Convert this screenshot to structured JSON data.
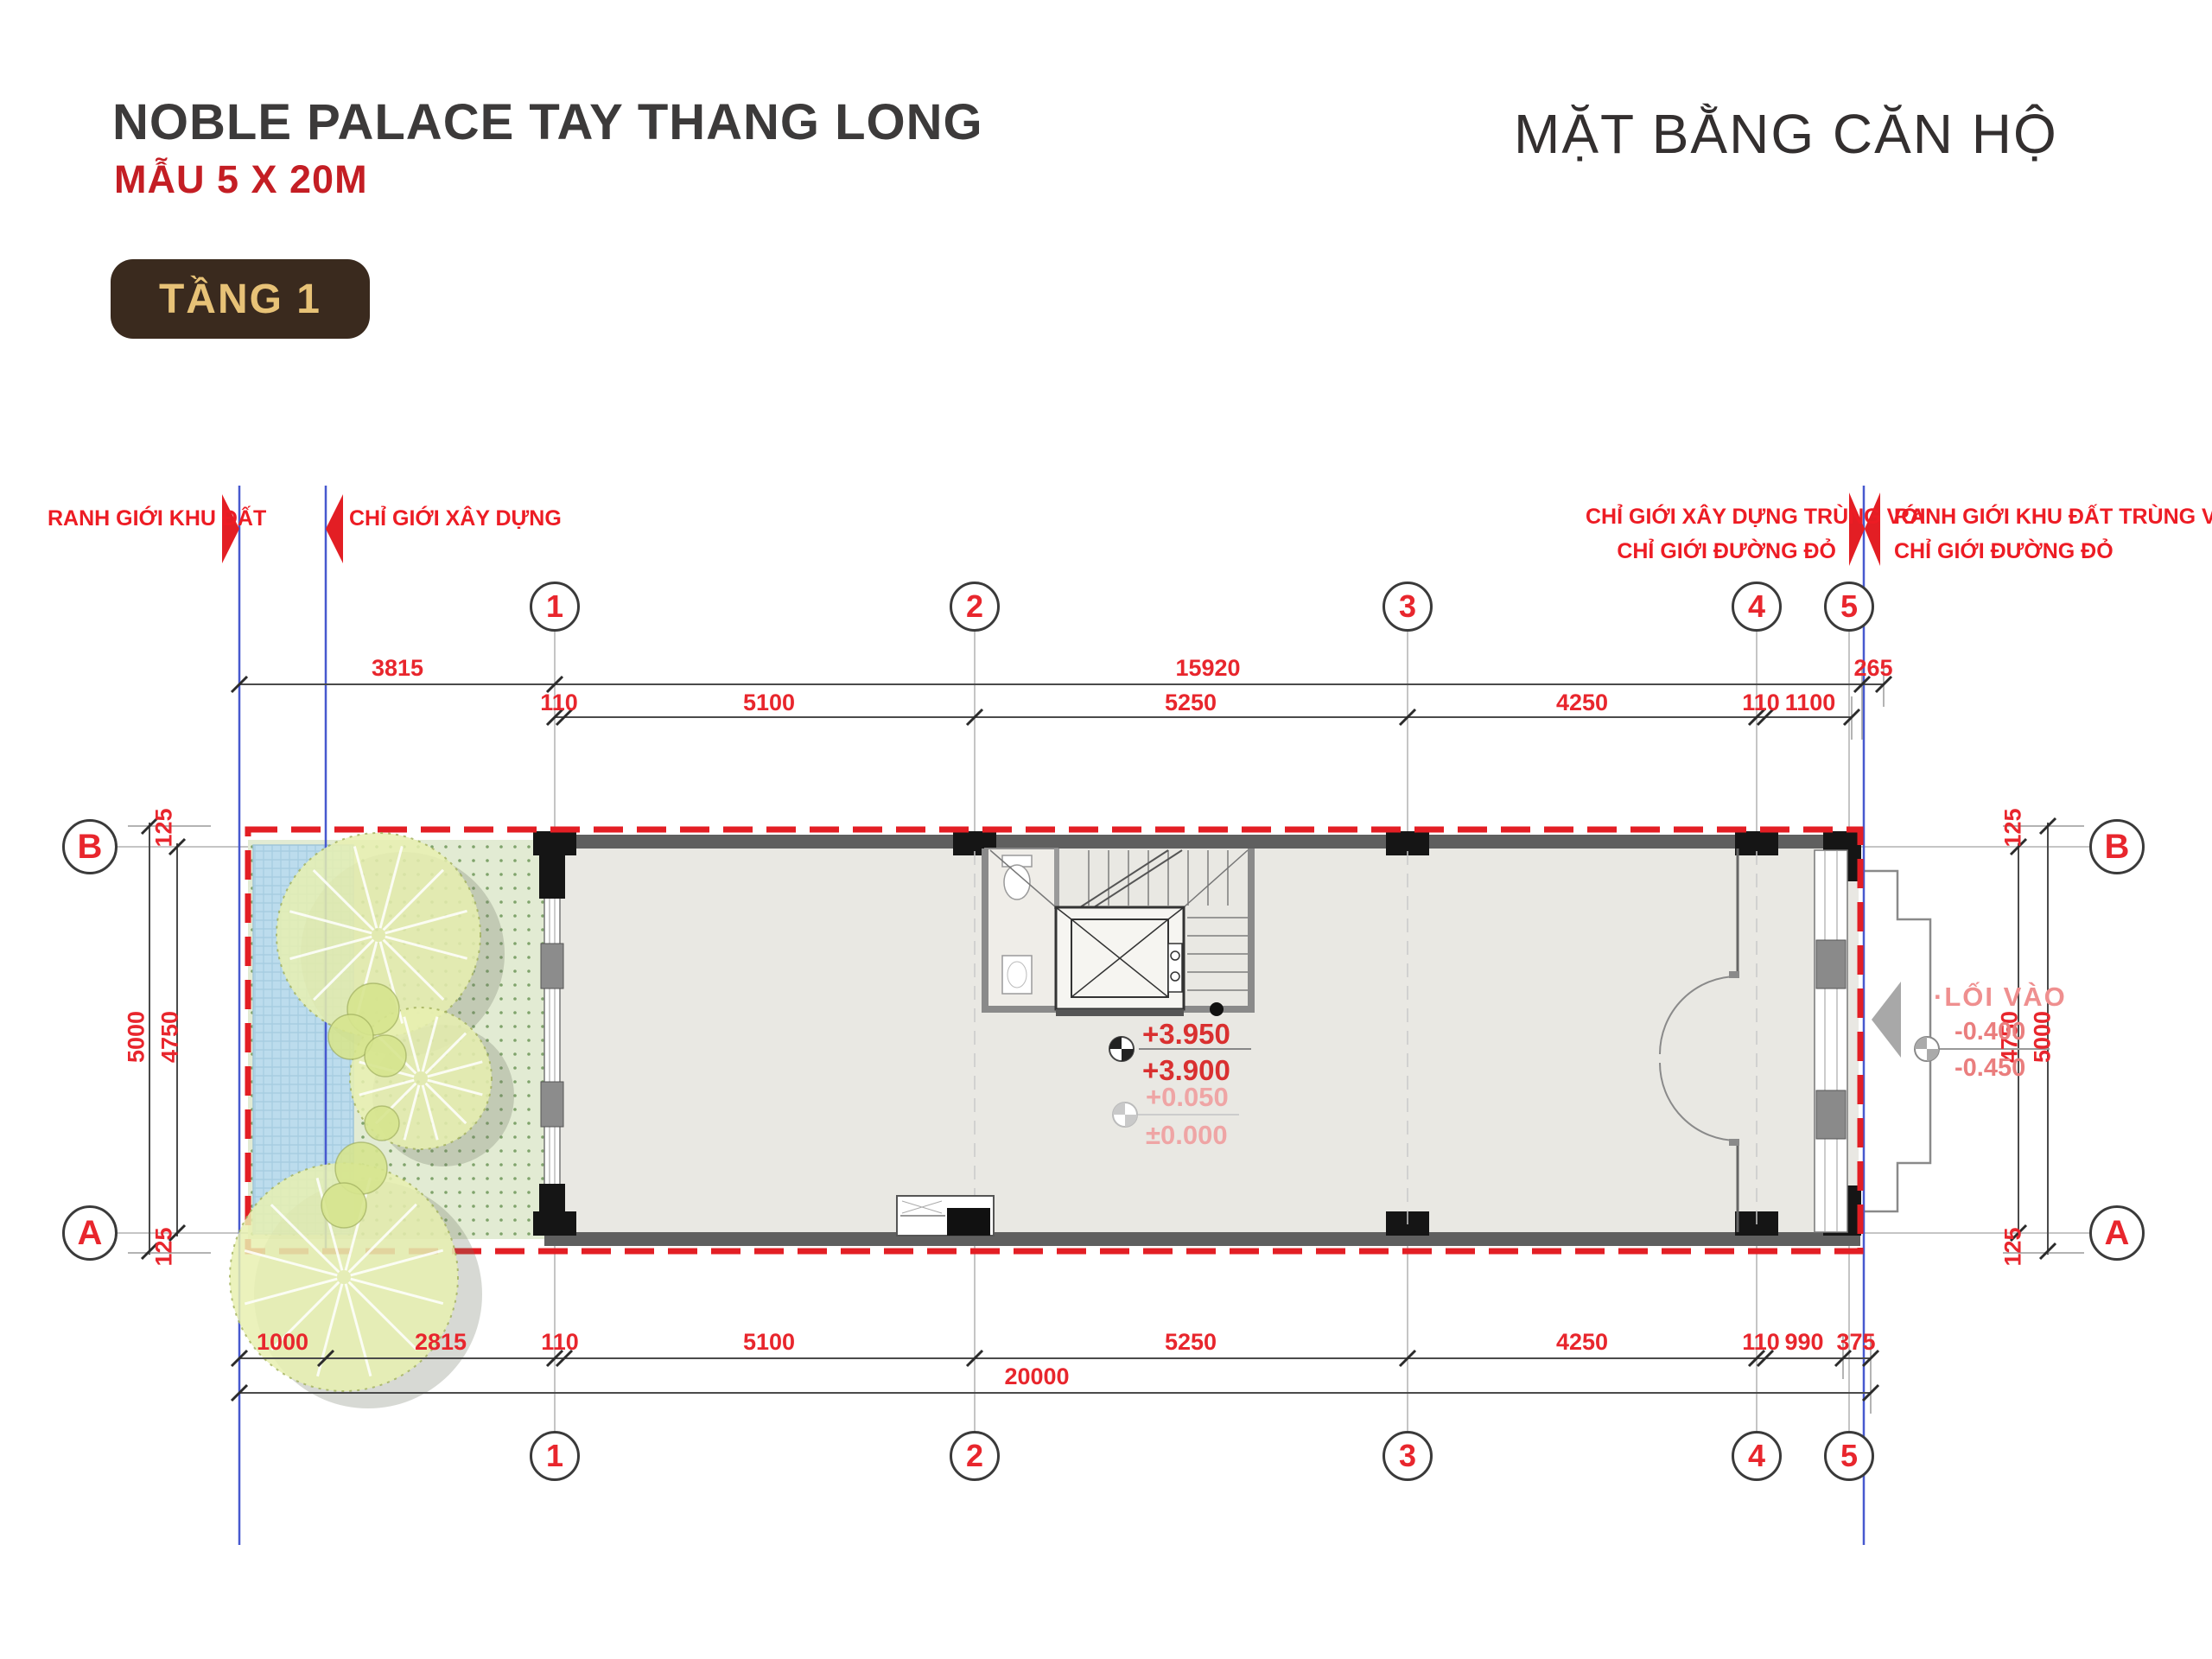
{
  "header": {
    "title": "NOBLE PALACE TAY THANG LONG",
    "subtitle": "MẪU 5 X 20M",
    "floor_badge": "TẦNG 1",
    "plan_type": "MẶT BẰNG CĂN HỘ"
  },
  "boundary_labels": {
    "left_outer": "RANH GIỚI KHU ĐẤT",
    "left_inner": "CHỈ GIỚI XÂY DỰNG",
    "right_inner_line1": "CHỈ GIỚI XÂY DỰNG TRÙNG VỚI",
    "right_inner_line2": "CHỈ GIỚI ĐƯỜNG ĐỎ",
    "right_outer_line1": "RANH GIỚI KHU ĐẤT TRÙNG VỚI",
    "right_outer_line2": "CHỈ GIỚI ĐƯỜNG ĐỎ"
  },
  "grid": {
    "columns": [
      "1",
      "2",
      "3",
      "4",
      "5"
    ],
    "rows": [
      "B",
      "A"
    ]
  },
  "dimensions": {
    "top_row1": [
      "3815",
      "15920",
      "265"
    ],
    "top_row2": [
      "110",
      "5100",
      "5250",
      "4250",
      "110",
      "1100"
    ],
    "bottom_row1": [
      "1000",
      "2815",
      "110",
      "5100",
      "5250",
      "4250",
      "110",
      "990",
      "375"
    ],
    "bottom_total": "20000",
    "left_outer": "5000",
    "left_inner": "4750",
    "left_edge_top": "125",
    "left_edge_bottom": "125",
    "right_inner": "4750",
    "right_outer": "5000",
    "right_edge_top": "125",
    "right_edge_bottom": "125"
  },
  "annotations": {
    "entrance": "·LỐI VÀO",
    "level_upper_1": "+3.950",
    "level_upper_2": "+3.900",
    "level_ground_1": "+0.050",
    "level_ground_2": "±0.000",
    "level_entry_1": "-0.400",
    "level_entry_2": "-0.450"
  },
  "colors": {
    "annotation_red": "#e8262d",
    "boundary_red": "#e31e24",
    "property_blue": "#4759cf",
    "badge_bg": "#3a2a1e",
    "badge_gold": "#e7c277"
  }
}
